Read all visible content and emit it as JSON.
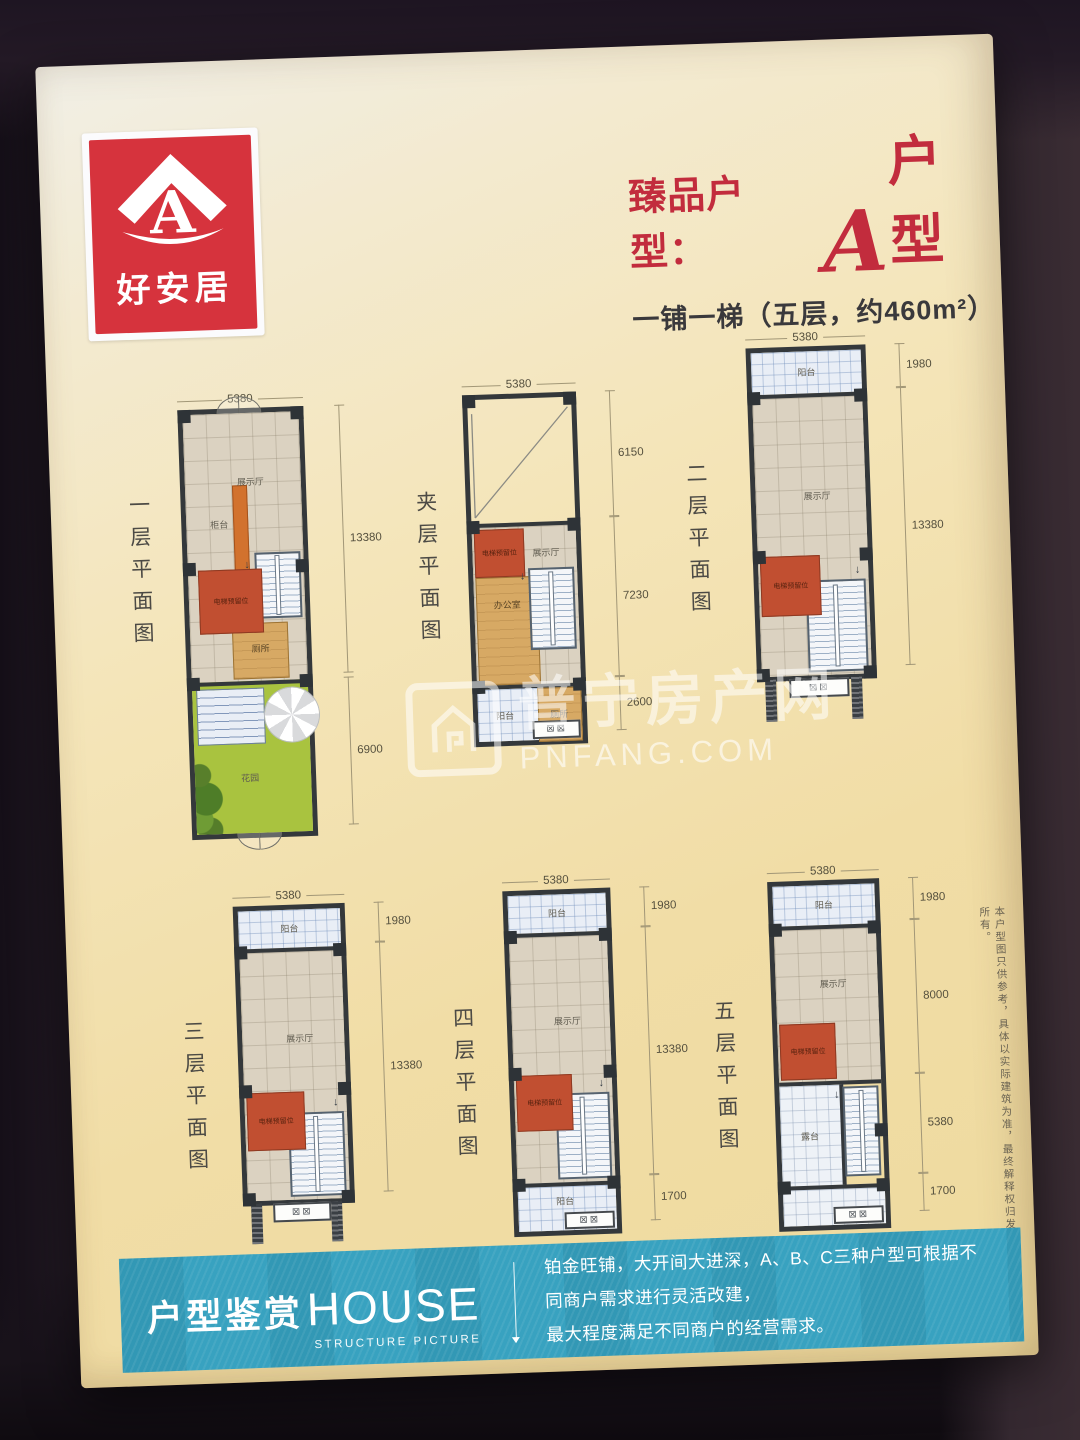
{
  "logo": {
    "name": "好安居",
    "letter": "A"
  },
  "header": {
    "title_prefix": "臻品户型：",
    "title_letter": "A",
    "title_suffix": "户型",
    "subtitle": "一铺一梯（五层，约460m²）"
  },
  "plans": [
    {
      "title": "一层平面图",
      "dim_top": "5380",
      "dim_side": [
        "13380",
        "6900"
      ],
      "labels": {
        "hall": "展示厅",
        "counter": "柜台",
        "elevator": "电梯预留位",
        "toilet": "厕所",
        "garden": "花园"
      }
    },
    {
      "title": "夹层平面图",
      "dim_top": "5380",
      "dim_side": [
        "6150",
        "7230",
        "2600"
      ],
      "labels": {
        "elevator": "电梯预留位",
        "hall": "展示厅",
        "office": "办公室",
        "balcony": "阳台",
        "toilet": "厕所"
      }
    },
    {
      "title": "二层平面图",
      "dim_top": "5380",
      "dim_side": [
        "1980",
        "13380"
      ],
      "labels": {
        "balcony": "阳台",
        "hall": "展示厅",
        "elevator": "电梯预留位"
      }
    },
    {
      "title": "三层平面图",
      "dim_top": "5380",
      "dim_side": [
        "1980",
        "13380"
      ],
      "labels": {
        "balcony": "阳台",
        "hall": "展示厅",
        "elevator": "电梯预留位"
      }
    },
    {
      "title": "四层平面图",
      "dim_top": "5380",
      "dim_side": [
        "1980",
        "13380",
        "1700"
      ],
      "labels": {
        "balcony": "阳台",
        "hall": "展示厅",
        "elevator": "电梯预留位",
        "balcony_bottom": "阳台"
      }
    },
    {
      "title": "五层平面图",
      "dim_top": "5380",
      "dim_side": [
        "1980",
        "8000",
        "5380",
        "1700"
      ],
      "labels": {
        "balcony": "阳台",
        "hall": "展示厅",
        "elevator": "电梯预留位",
        "terrace": "露台"
      }
    }
  ],
  "watermark": {
    "cn": "普宁房产网",
    "en": "PNFANG.COM"
  },
  "disclaimer": "本户型图只供参考，具体以实际建筑为准，最终解释权归发展商所有。",
  "banner": {
    "title_zh": "户型鉴赏",
    "title_en": "HOUSE",
    "title_sub": "STRUCTURE PICTURE",
    "desc_line1": "铂金旺铺，大开间大进深，A、B、C三种户型可根据不同商户需求进行灵活改建，",
    "desc_line2": "最大程度满足不同商户的经营需求。"
  },
  "icons": {
    "window_glyph": "⊠⊠",
    "down_arrow": "↓"
  },
  "colors": {
    "accent_red": "#c22c3d",
    "logo_red": "#d6333d",
    "banner_teal": "#38a2c0",
    "elevator_red": "#c14f31",
    "garden_green": "#a9c33f"
  }
}
